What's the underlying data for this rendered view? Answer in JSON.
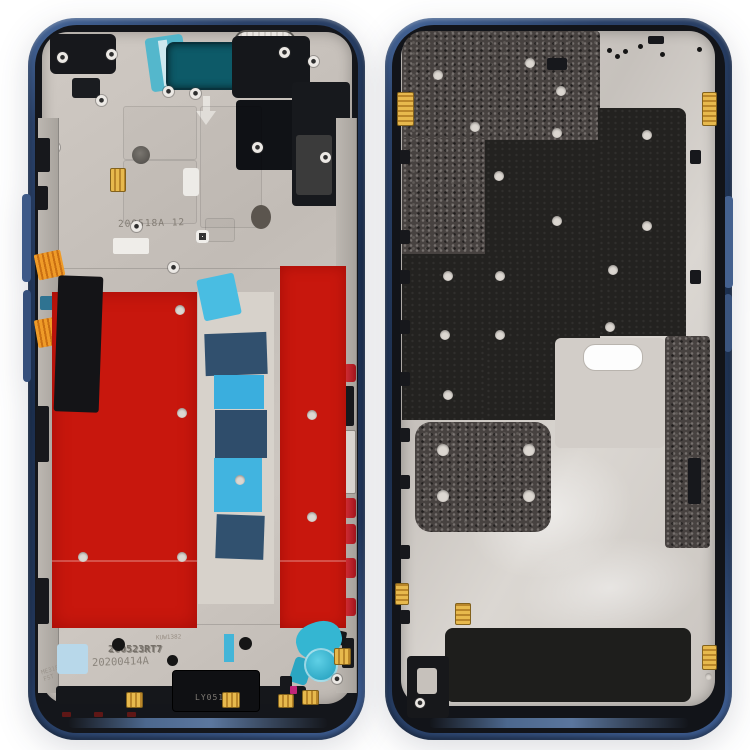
{
  "image": {
    "subject": "Front and back product photo of a navy blue smartphone middle frame bezel plate",
    "background_color": "#ffffff"
  },
  "front_frame": {
    "markings": {
      "board_code": "200518A 12",
      "etch_small": "KUW1382",
      "etch_code_1": "200523RT7",
      "etch_code_2": "20200414A",
      "etch_side_line1": "ME318B",
      "etch_side_line2": "FST",
      "speaker_label": "LY0514"
    }
  },
  "back_frame": {
    "markings": {}
  },
  "colors": {
    "frame_navy": "#22375a",
    "frame_black": "#14161b",
    "plate_front": "#c8c2bc",
    "plate_back": "#cdc8c3",
    "sticker_red": "#c8170d",
    "tape_cyan": "#41b4e0",
    "tape_navy": "#31506e",
    "earpiece_teal": "#0d5a68",
    "flex_orange": "#e08a1f",
    "contact_gold": "#d9a93f",
    "button_red": "#c21f26",
    "pad_lightblue": "#b8d8ea",
    "component_cyan": "#34b6d2",
    "speckle_dark": "#474240"
  }
}
